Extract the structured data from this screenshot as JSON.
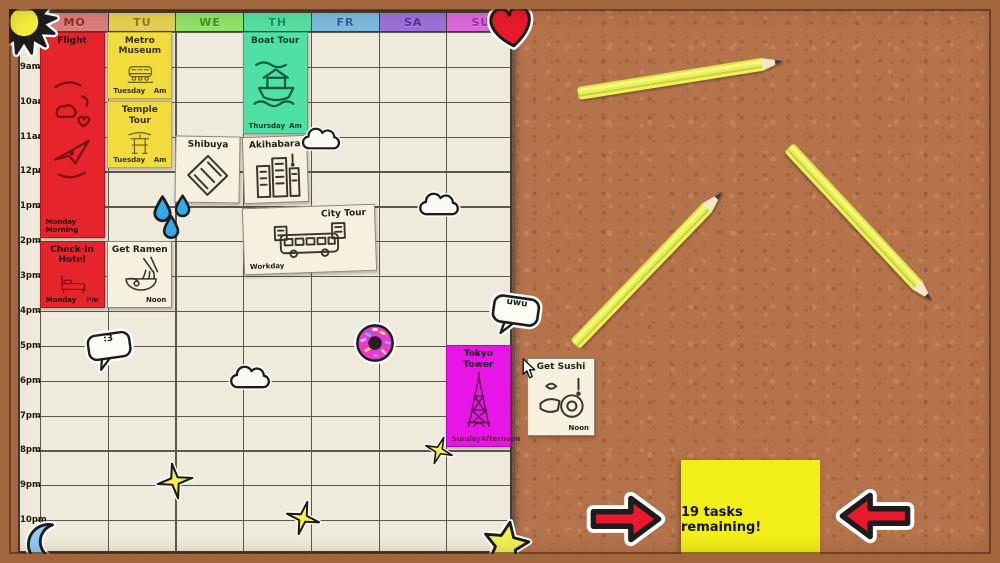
{
  "calendar": {
    "day_headers": [
      {
        "label": "MO",
        "bg": "#d97c7c",
        "fg": "#93281e"
      },
      {
        "label": "TU",
        "bg": "#e5cf52",
        "fg": "#8f7a1a"
      },
      {
        "label": "WE",
        "bg": "#90e26a",
        "fg": "#38951e"
      },
      {
        "label": "TH",
        "bg": "#55dfa3",
        "fg": "#14906a"
      },
      {
        "label": "FR",
        "bg": "#7cb9dd",
        "fg": "#2b5d9d"
      },
      {
        "label": "SA",
        "bg": "#9c70d9",
        "fg": "#58279c"
      },
      {
        "label": "SU",
        "bg": "#da68da",
        "fg": "#952b9c"
      }
    ],
    "time_labels": [
      "8am",
      "9am",
      "10am",
      "11am",
      "12pm",
      "1pm",
      "2pm",
      "3pm",
      "4pm",
      "5pm",
      "6pm",
      "7pm",
      "8pm",
      "9pm",
      "10pm"
    ]
  },
  "notes": [
    {
      "id": "flight",
      "title": "Flight",
      "footer_left": "Monday Morning",
      "footer_right": "",
      "color": "red",
      "icon": "plane-sketch",
      "day": 0,
      "row": 0,
      "rows": 6,
      "cols": 1
    },
    {
      "id": "check-in-hotel",
      "title": "Check-in\nHotel",
      "footer_left": "Monday",
      "footer_right": "Pm",
      "color": "red",
      "icon": "bed-sketch",
      "day": 0,
      "row": 6,
      "rows": 2,
      "cols": 1
    },
    {
      "id": "metro-museum",
      "title": "Metro\nMuseum",
      "footer_left": "Tuesday",
      "footer_right": "Am",
      "color": "yellow",
      "icon": "train-sketch",
      "day": 1,
      "row": 0,
      "rows": 2,
      "cols": 1
    },
    {
      "id": "temple-tour",
      "title": "Temple Tour",
      "footer_left": "Tuesday",
      "footer_right": "Am",
      "color": "yellow",
      "icon": "torii-sketch",
      "day": 1,
      "row": 2,
      "rows": 2,
      "cols": 1
    },
    {
      "id": "get-ramen",
      "title": "Get Ramen",
      "footer_left": "",
      "footer_right": "Noon",
      "color": "cream",
      "icon": "ramen-sketch",
      "day": 1,
      "row": 6,
      "rows": 2,
      "cols": 1
    },
    {
      "id": "shibuya",
      "title": "Shibuya",
      "footer_left": "",
      "footer_right": "",
      "color": "cream",
      "icon": "crossing-sketch",
      "day": 2,
      "row": 3,
      "rows": 2,
      "cols": 1,
      "tilt": 1
    },
    {
      "id": "boat-tour",
      "title": "Boat Tour",
      "footer_left": "Thursday",
      "footer_right": "Am",
      "color": "mint",
      "icon": "boat-sketch",
      "day": 3,
      "row": 0,
      "rows": 3,
      "cols": 1
    },
    {
      "id": "akihabara",
      "title": "Akihabara",
      "footer_left": "",
      "footer_right": "",
      "color": "cream",
      "icon": "buildings-sketch",
      "day": 3,
      "row": 3,
      "rows": 2,
      "cols": 1,
      "tilt": -2
    },
    {
      "id": "city-tour",
      "title": "City Tour",
      "footer_left": "Workday",
      "footer_right": "",
      "color": "cream",
      "icon": "bus-sketch",
      "day": 3,
      "row": 5,
      "rows": 2,
      "cols": 2,
      "tilt": -2,
      "title_align": "right"
    },
    {
      "id": "tokyo-tower",
      "title": "Tokyo Tower",
      "footer_left": "SundayAfternoon",
      "footer_right": "",
      "color": "magenta",
      "icon": "tower-sketch",
      "day": 6,
      "row": 9,
      "rows": 3,
      "cols": 1
    },
    {
      "id": "get-sushi",
      "title": "Get Sushi",
      "footer_left": "",
      "footer_right": "Noon",
      "color": "cream",
      "icon": "sushi-sketch",
      "off_board": true,
      "x": 527,
      "y": 358,
      "w": 68,
      "h": 78
    }
  ],
  "stickers": [
    {
      "name": "sun-sticker",
      "type": "sun",
      "x": -12,
      "y": -14,
      "w": 72,
      "h": 72
    },
    {
      "name": "heart-sticker",
      "type": "heart",
      "x": 486,
      "y": 2,
      "w": 50,
      "h": 48,
      "rot": -8
    },
    {
      "name": "moon-sticker",
      "type": "moon",
      "x": 20,
      "y": 522,
      "w": 46,
      "h": 46
    },
    {
      "name": "cloud-sticker",
      "type": "cloud",
      "x": 299,
      "y": 124,
      "w": 44,
      "h": 31
    },
    {
      "name": "cloud-sticker",
      "type": "cloud",
      "x": 416,
      "y": 189,
      "w": 46,
      "h": 32
    },
    {
      "name": "cloud-sticker",
      "type": "cloud",
      "x": 227,
      "y": 362,
      "w": 46,
      "h": 32
    },
    {
      "name": "droplets-sticker",
      "type": "droplets",
      "x": 147,
      "y": 192,
      "w": 52,
      "h": 46
    },
    {
      "name": "donut-sticker",
      "type": "donut",
      "x": 354,
      "y": 322,
      "w": 42,
      "h": 42
    },
    {
      "name": "speech-bubble-sticker",
      "type": "bubble",
      "x": 84,
      "y": 327,
      "w": 52,
      "h": 50,
      "rot": -8,
      "text": ":3"
    },
    {
      "name": "speech-bubble-sticker",
      "type": "bubble",
      "x": 487,
      "y": 291,
      "w": 56,
      "h": 52,
      "rot": 8,
      "text": "uwu"
    },
    {
      "name": "sparkle-sticker",
      "type": "sparkle",
      "x": 156,
      "y": 460,
      "w": 38,
      "h": 42,
      "rot": -10
    },
    {
      "name": "sparkle-sticker",
      "type": "sparkle",
      "x": 285,
      "y": 498,
      "w": 36,
      "h": 40,
      "rot": 15
    },
    {
      "name": "sparkle-sticker",
      "type": "sparkle",
      "x": 424,
      "y": 434,
      "w": 30,
      "h": 33,
      "rot": 20
    },
    {
      "name": "star-sticker",
      "type": "star",
      "x": 478,
      "y": 520,
      "w": 56,
      "h": 50,
      "rot": 10
    },
    {
      "name": "arrow-sticker-left",
      "type": "arrow",
      "x": 584,
      "y": 490,
      "w": 84,
      "h": 58,
      "dir": "right"
    },
    {
      "name": "arrow-sticker-right",
      "type": "arrow",
      "x": 833,
      "y": 487,
      "w": 84,
      "h": 58,
      "dir": "left"
    },
    {
      "name": "mouse-cursor",
      "type": "cursor",
      "x": 522,
      "y": 358,
      "w": 15,
      "h": 21
    }
  ],
  "pencils": [
    {
      "x": 578,
      "y": 87,
      "len": 208,
      "rot": -9
    },
    {
      "x": 575,
      "y": 338,
      "len": 212,
      "rot": -46
    },
    {
      "x": 789,
      "y": 141,
      "len": 210,
      "rot": 47
    }
  ],
  "tasks_note": {
    "text": "19 tasks remaining!"
  }
}
